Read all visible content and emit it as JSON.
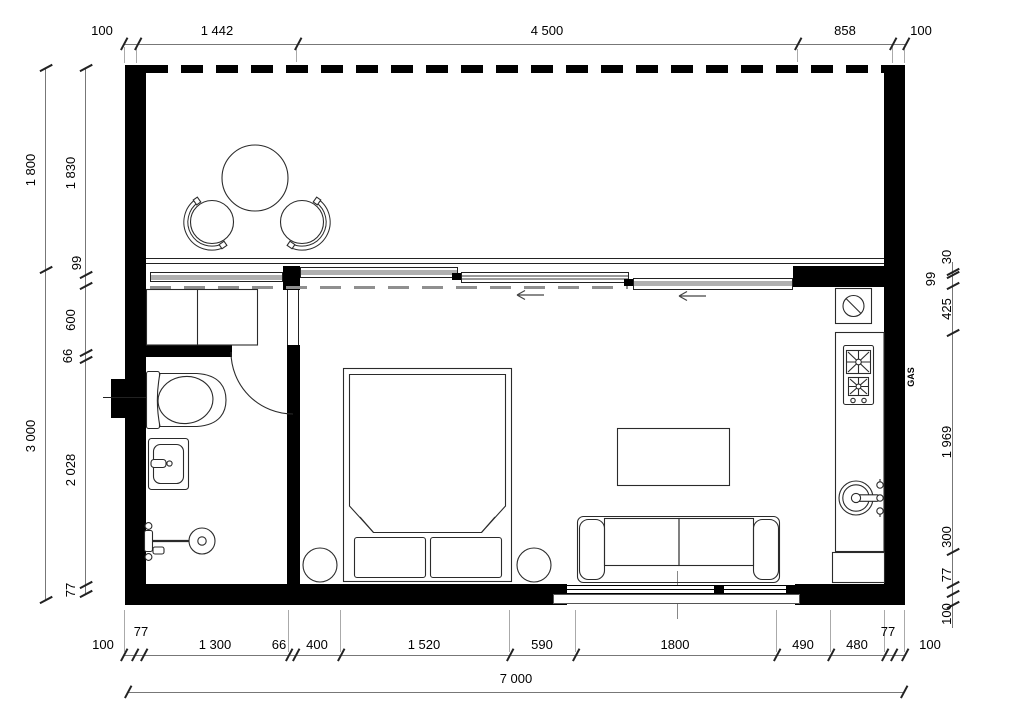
{
  "drawing": {
    "type": "floor-plan"
  },
  "dims": {
    "top": [
      "100",
      "1 442",
      "4 500",
      "858",
      "100"
    ],
    "left_outer": [
      "1 800",
      "3 000"
    ],
    "left_inner": [
      "1 830",
      "99",
      "600",
      "66",
      "2 028",
      "77"
    ],
    "right": [
      "30",
      "99",
      "425",
      "1 969",
      "300",
      "77",
      "100"
    ],
    "bottom": [
      "100",
      "77",
      "1 300",
      "66",
      "400",
      "1 520",
      "590",
      "1800",
      "490",
      "480",
      "77",
      "100"
    ],
    "total": "7 000"
  },
  "labels": {
    "gas": "GAS"
  },
  "colors": {
    "wall": "#000000",
    "line": "#2b2b2b",
    "dim_line": "#777777",
    "glass_gray": "#b0b0b0"
  }
}
